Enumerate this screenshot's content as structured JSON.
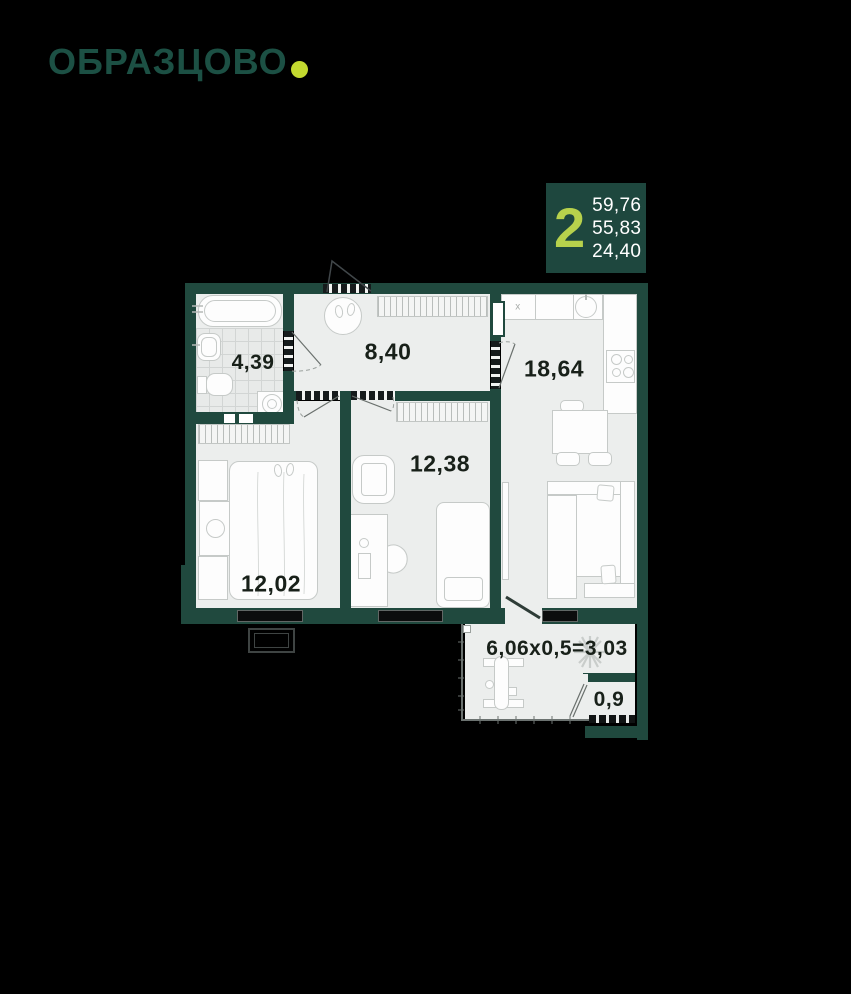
{
  "brand": {
    "logo_text": "ОБРАЗЦОВО"
  },
  "badge": {
    "rooms_count": "2",
    "areas": [
      "59,76",
      "55,83",
      "24,40"
    ]
  },
  "plan": {
    "rooms": [
      {
        "name": "bathroom",
        "area": "4,39"
      },
      {
        "name": "hallway",
        "area": "8,40"
      },
      {
        "name": "kitchen-living",
        "area": "18,64"
      },
      {
        "name": "bedroom-2",
        "area": "12,38"
      },
      {
        "name": "bedroom-1",
        "area": "12,02"
      },
      {
        "name": "balcony",
        "area": "6,06x0,5=3,03"
      },
      {
        "name": "balcony-storage",
        "area": "0,9"
      }
    ],
    "symbols": {
      "sink_mark": "x"
    },
    "colors": {
      "wall": "#20493E",
      "accent_lime": "#BCD443",
      "floor": "#ECEEED",
      "background": "#000000"
    }
  }
}
